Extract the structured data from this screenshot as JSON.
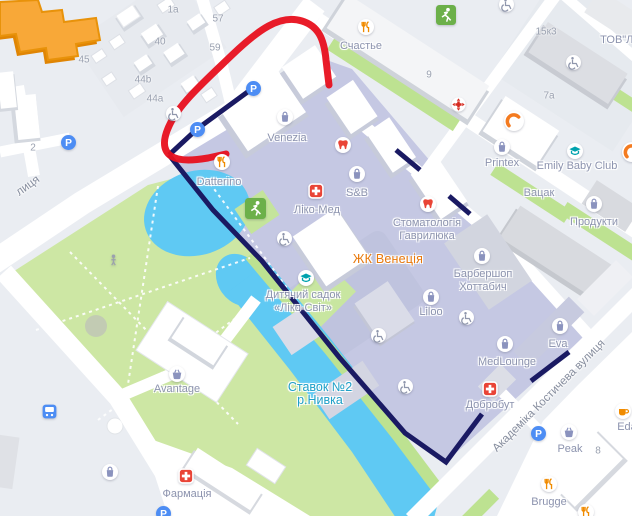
{
  "title": "Map of residential complex ЖК Венеція with hand-drawn route annotations",
  "colors": {
    "background": "#EAEDF2",
    "road_white": "#FFFFFF",
    "park_green": "#CDE7A4",
    "strip_green": "#BDE291",
    "water_blue": "#5FC9F3",
    "highlight_lavender": "#C5C8E3",
    "route_navy": "#1A1A63",
    "annotation_red": "#E8101D",
    "building_orange": "#F8A838",
    "poi_label_grey": "#8C93AE",
    "area_label_orange": "#E8780A",
    "water_label_teal": "#1FA0C8",
    "parking_blue": "#4D8DF4"
  },
  "annotations": {
    "red_route": "hand-drawn red route line",
    "navy_route": "navy outline around ЖК Венеція block"
  },
  "street_labels": [
    {
      "id": "street-left",
      "text": "лиця",
      "x": 28,
      "y": 186,
      "rot": -36
    },
    {
      "id": "street-kostycheva",
      "text": "Академіка Костичева вулиця",
      "x": 549,
      "y": 396,
      "rot": -45
    }
  ],
  "building_numbers": [
    {
      "text": "1a",
      "x": 173,
      "y": 10
    },
    {
      "text": "57",
      "x": 218,
      "y": 19
    },
    {
      "text": "59",
      "x": 215,
      "y": 48
    },
    {
      "text": "40",
      "x": 160,
      "y": 42
    },
    {
      "text": "45",
      "x": 84,
      "y": 60
    },
    {
      "text": "44b",
      "x": 143,
      "y": 80
    },
    {
      "text": "44a",
      "x": 155,
      "y": 99
    },
    {
      "text": "2",
      "x": 33,
      "y": 148
    },
    {
      "text": "9",
      "x": 429,
      "y": 75
    },
    {
      "text": "15к3",
      "x": 546,
      "y": 32
    },
    {
      "text": "7а",
      "x": 549,
      "y": 96
    },
    {
      "text": "8",
      "x": 598,
      "y": 451
    }
  ],
  "pois": [
    {
      "id": "schastye",
      "icon": "restaurant",
      "x": 366,
      "y": 27,
      "label": "Счастье",
      "lx": 361,
      "ly": 48,
      "inter": true
    },
    {
      "id": "tov",
      "label": "ТОВ\"Лі",
      "lx": 618,
      "ly": 42,
      "inter": true
    },
    {
      "id": "venezia",
      "icon": "bag",
      "x": 285,
      "y": 117,
      "label": "Venezia",
      "lx": 287,
      "ly": 140,
      "inter": true
    },
    {
      "id": "datterino",
      "icon": "restaurant",
      "x": 222,
      "y": 162,
      "label": "Datterino",
      "lx": 219,
      "ly": 184,
      "inter": true
    },
    {
      "id": "liko-med",
      "icon": "medcross",
      "x": 316,
      "y": 191,
      "label": "Ліко-Мед",
      "lx": 317,
      "ly": 212,
      "inter": true
    },
    {
      "id": "sb",
      "icon": "bag",
      "x": 357,
      "y": 174,
      "label": "S&B",
      "lx": 357,
      "ly": 195,
      "inter": true
    },
    {
      "id": "stomatology",
      "icon": "tooth",
      "x": 428,
      "y": 204,
      "lines": [
        "Стоматологія",
        "Гаврилюка"
      ],
      "lx": 427,
      "ly": 225,
      "inter": true
    },
    {
      "id": "tooth-2",
      "icon": "tooth",
      "x": 343,
      "y": 145,
      "inter": true
    },
    {
      "id": "zhk-venetsia",
      "label": "ЖК Венеція",
      "lx": 388,
      "ly": 261,
      "type": "area-orange",
      "inter": true
    },
    {
      "id": "barbershop",
      "icon": "bag",
      "x": 482,
      "y": 256,
      "lines": [
        "Барбершоп",
        "Хоттабич"
      ],
      "lx": 483,
      "ly": 276,
      "inter": true
    },
    {
      "id": "liloo",
      "icon": "bag",
      "x": 431,
      "y": 297,
      "label": "Liloo",
      "lx": 431,
      "ly": 314,
      "inter": true
    },
    {
      "id": "medlounge",
      "icon": "bag",
      "x": 505,
      "y": 344,
      "label": "MedLounge",
      "lx": 507,
      "ly": 364,
      "inter": true
    },
    {
      "id": "eva",
      "icon": "bag",
      "x": 560,
      "y": 326,
      "label": "Eva",
      "lx": 558,
      "ly": 346,
      "inter": true
    },
    {
      "id": "dobrobut",
      "icon": "medcross",
      "x": 490,
      "y": 389,
      "label": "Добробут",
      "lx": 490,
      "ly": 407,
      "inter": true
    },
    {
      "id": "printex",
      "icon": "bag",
      "x": 502,
      "y": 147,
      "label": "Printex",
      "lx": 502,
      "ly": 165,
      "inter": true
    },
    {
      "id": "emily-baby-club",
      "icon": "cap",
      "x": 575,
      "y": 151,
      "label": "Emily Baby Club",
      "lx": 577,
      "ly": 168,
      "inter": true
    },
    {
      "id": "vatsak",
      "label": "Вацак",
      "lx": 539,
      "ly": 195,
      "inter": true
    },
    {
      "id": "produkty",
      "icon": "bag",
      "x": 594,
      "y": 204,
      "label": "Продукти",
      "lx": 594,
      "ly": 224,
      "inter": true
    },
    {
      "id": "kindergarten",
      "icon": "cap",
      "x": 306,
      "y": 278,
      "lines": [
        "Дитячий садок",
        "«Ліко-Світ»"
      ],
      "lx": 303,
      "ly": 297,
      "inter": true
    },
    {
      "id": "stavok",
      "lines": [
        "Ставок №2",
        "р.Нивка"
      ],
      "lx": 320,
      "ly": 389,
      "type": "water",
      "inter": true
    },
    {
      "id": "avantage",
      "icon": "basket",
      "x": 177,
      "y": 374,
      "label": "Avantage",
      "lx": 177,
      "ly": 391,
      "inter": true
    },
    {
      "id": "pharmacy",
      "icon": "medcross",
      "x": 186,
      "y": 476,
      "label": "Фармація",
      "lx": 187,
      "ly": 496,
      "inter": true
    },
    {
      "id": "peak",
      "icon": "basket",
      "x": 569,
      "y": 432,
      "label": "Peak",
      "lx": 570,
      "ly": 451,
      "inter": true
    },
    {
      "id": "eda",
      "icon": "coffee",
      "x": 623,
      "y": 411,
      "label": "Eda",
      "lx": 627,
      "ly": 429,
      "inter": true
    },
    {
      "id": "brugge",
      "icon": "restaurant",
      "x": 549,
      "y": 484,
      "label": "Brugge",
      "lx": 549,
      "ly": 504,
      "inter": true
    },
    {
      "id": "brugge-2",
      "icon": "restaurant",
      "x": 586,
      "y": 512,
      "inter": true
    },
    {
      "id": "c-logo",
      "icon": "clogo",
      "x": 514,
      "y": 121,
      "size": 20,
      "inter": true
    },
    {
      "id": "c-logo-2",
      "icon": "clogo",
      "x": 632,
      "y": 152,
      "size": 20,
      "inter": true
    },
    {
      "id": "first-aid",
      "icon": "firstaid",
      "x": 458,
      "y": 104,
      "size": 15,
      "inter": true
    },
    {
      "id": "parking-1",
      "icon": "parking",
      "x": 253,
      "y": 88,
      "size": 15,
      "inter": true
    },
    {
      "id": "parking-2",
      "icon": "parking",
      "x": 197,
      "y": 129,
      "size": 15,
      "inter": true
    },
    {
      "id": "parking-3",
      "icon": "parking",
      "x": 68,
      "y": 142,
      "size": 15,
      "inter": true
    },
    {
      "id": "parking-4",
      "icon": "parking",
      "x": 538,
      "y": 433,
      "size": 15,
      "inter": true
    },
    {
      "id": "parking-5",
      "icon": "parking",
      "x": 163,
      "y": 513,
      "size": 15,
      "inter": true
    },
    {
      "id": "wheelchair-1",
      "icon": "wheelchair",
      "x": 173,
      "y": 113,
      "size": 15,
      "inter": false
    },
    {
      "id": "wheelchair-2",
      "icon": "wheelchair",
      "x": 284,
      "y": 238,
      "size": 15,
      "inter": false
    },
    {
      "id": "wheelchair-3",
      "icon": "wheelchair",
      "x": 466,
      "y": 317,
      "size": 15,
      "inter": false
    },
    {
      "id": "wheelchair-4",
      "icon": "wheelchair",
      "x": 378,
      "y": 335,
      "size": 15,
      "inter": false
    },
    {
      "id": "wheelchair-5",
      "icon": "wheelchair",
      "x": 405,
      "y": 386,
      "size": 15,
      "inter": false
    },
    {
      "id": "wheelchair-6",
      "icon": "wheelchair",
      "x": 573,
      "y": 62,
      "size": 15,
      "inter": false
    },
    {
      "id": "wheelchair-7",
      "icon": "wheelchair",
      "x": 506,
      "y": 4,
      "size": 15,
      "inter": false
    },
    {
      "id": "playground-1",
      "icon": "runner",
      "x": 255,
      "y": 208,
      "size": 21,
      "inter": false
    },
    {
      "id": "playground-2",
      "icon": "runner",
      "x": 446,
      "y": 15,
      "size": 20,
      "inter": false
    },
    {
      "id": "park-person",
      "icon": "person",
      "x": 113,
      "y": 259,
      "size": 13,
      "inter": false
    },
    {
      "id": "bus-stop",
      "icon": "bus",
      "x": 49,
      "y": 411,
      "size": 15,
      "inter": true
    },
    {
      "id": "shop-sw",
      "icon": "bag",
      "x": 110,
      "y": 472,
      "inter": true
    }
  ]
}
